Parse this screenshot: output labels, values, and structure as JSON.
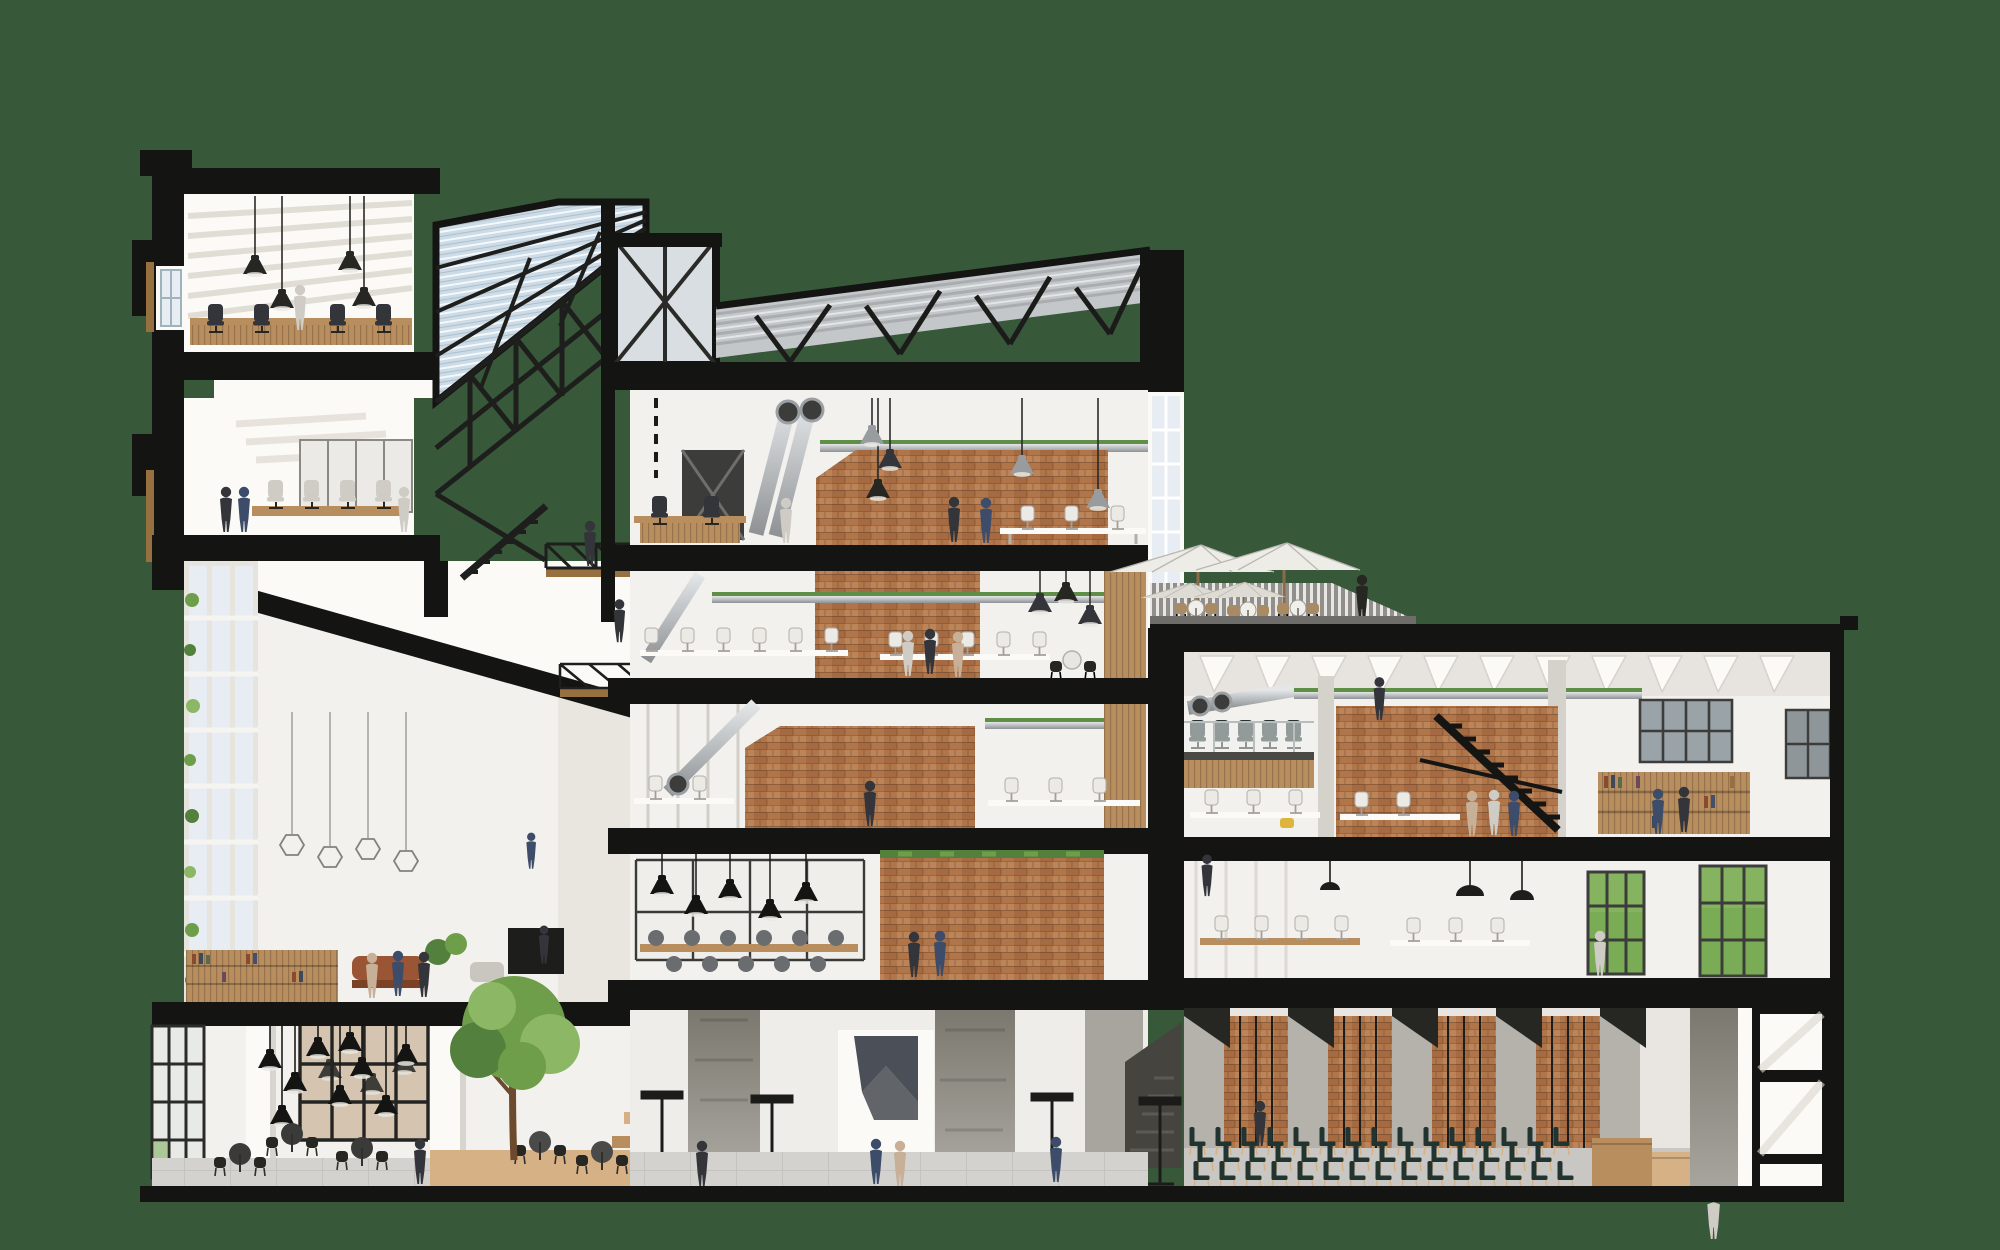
{
  "meta": {
    "title": "Architectural cross-section rendering",
    "type": "sectional perspective illustration of a multi-storey office building",
    "background": "solid green backdrop, building cut showing black structural slabs"
  },
  "palette": {
    "bg": "#38583a",
    "ink": "#141413",
    "ink-soft": "#262623",
    "white": "#f3f1ed",
    "white-bright": "#fbfaf7",
    "grey-wall": "#e4e1db",
    "grey-mid": "#cfccc6",
    "concrete": "#b3b0aa",
    "concrete-dark": "#6f6d67",
    "concrete-darker": "#504e49",
    "brick": "#b1754a",
    "brick-dark": "#8f5731",
    "wood": "#b98e5f",
    "wood-light": "#d6b186",
    "wood-dark": "#97703f",
    "glass": "#cbdbe7",
    "glass-light": "#e7edf2",
    "steel": "#2c2c2a",
    "silver": "#c9ccce",
    "silver-dark": "#989c9f",
    "green-canopy": "#6f9e4b",
    "green-dark": "#54803d",
    "green-light": "#8cb765",
    "green-lawn": "#7aab55",
    "charcoal": "#33353a",
    "navy": "#3d4c68",
    "tan": "#c7b097",
    "chair-dark": "#223430",
    "yellow": "#ddb43e",
    "floor": "#d3d2ce",
    "umbrella": "#edece6",
    "rail": "#908f8b",
    "duct-green": "#5f8f46"
  },
  "scene": {
    "areas": [
      {
        "id": "left-tower-upper-meeting-room",
        "label": "Upper meeting room with black pendant lamps, wood desks and office chairs"
      },
      {
        "id": "left-tower-lower-meeting-room",
        "label": "Meeting room with conference table, grey chairs and glass partition"
      },
      {
        "id": "atrium",
        "label": "Tall white atrium with window wall, wire pendant lights and lounge mezzanine"
      },
      {
        "id": "skylight",
        "label": "Sloped steel-and-glass skylight with trusses, stair and bridges"
      },
      {
        "id": "ground-cafe",
        "label": "Ground floor cafe with cluster of black pendant lamps and round tables"
      },
      {
        "id": "courtyard-tree",
        "label": "Courtyard cafe with green tree and wood deck"
      },
      {
        "id": "central-roof",
        "label": "Corrugated sawtooth roof with steel struts"
      },
      {
        "id": "central-office-upper",
        "label": "Open office with brick core, ducts and industrial pendants"
      },
      {
        "id": "central-canteen",
        "label": "Canteen floor with long white tables"
      },
      {
        "id": "central-office-mid",
        "label": "Office floor with brick core and workstations"
      },
      {
        "id": "central-cafe-floor",
        "label": "Cafe floor with black pendants, glass partition and wood tables"
      },
      {
        "id": "central-lobby",
        "label": "Concrete lobby with piers, artwork wall and standing tables"
      },
      {
        "id": "roof-terrace",
        "label": "Roof terrace with white umbrellas, bistro tables and slatted railing"
      },
      {
        "id": "right-open-office",
        "label": "Double-height office with mezzanine, brick wall and black stair"
      },
      {
        "id": "right-library",
        "label": "Library mezzanine with bookshelves"
      },
      {
        "id": "right-lower-office",
        "label": "Office level with windows to green lawn"
      },
      {
        "id": "event-hall",
        "label": "Event hall with brick piers and rows of dark chairs"
      },
      {
        "id": "reception",
        "label": "Wood reception desk with attendant"
      }
    ],
    "counts": {
      "umbrellas": 4,
      "event_chair_rows": 3,
      "central_floors": 4,
      "left_tower_rooms": 2,
      "right_wing_levels": 3
    }
  }
}
